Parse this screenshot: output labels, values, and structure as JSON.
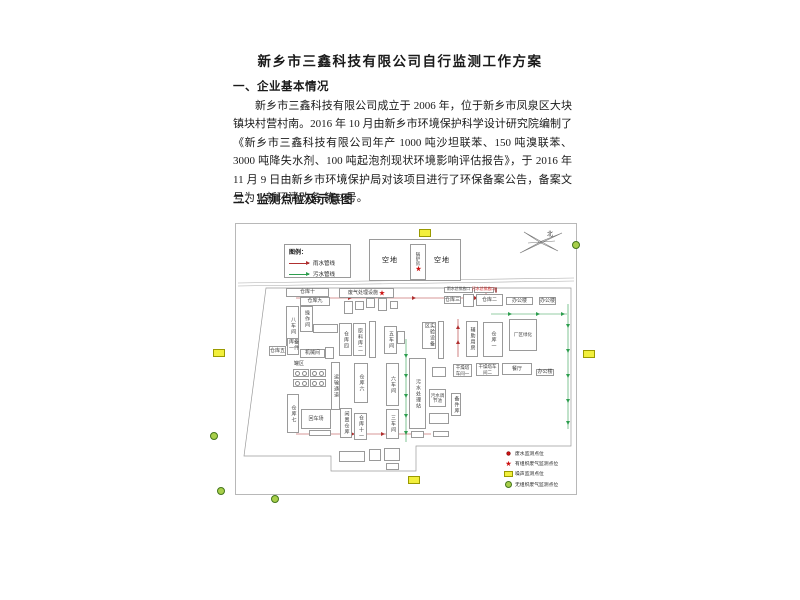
{
  "document": {
    "title": "新乡市三鑫科技有限公司自行监测工作方案",
    "section1_heading": "一、企业基本情况",
    "paragraph": "新乡市三鑫科技有限公司成立于 2006 年，位于新乡市凤泉区大块镇块村营村南。2016 年 10 月由新乡市环境保护科学设计研究院编制了《新乡市三鑫科技有限公司年产 1000 吨沙坦联苯、150 吨溴联苯、3000 吨降失水剂、100 吨起泡剂现状环境影响评估报告》，于 2016 年 11 月 9 日由新乡市环境保护局对该项目进行了环保备案公告，备案文号为：新环清改备 第 2 号。",
    "section2_heading": "二、监测点位及示意图"
  },
  "diagram": {
    "compass_label": "北",
    "pipe_legend": {
      "title": "图例：",
      "items": [
        {
          "name": "rain",
          "label": "雨水管线"
        },
        {
          "name": "sew",
          "label": "污水管线"
        }
      ]
    },
    "site": {
      "left_lot": "空地",
      "right_lot": "空地",
      "boiler": "锅炉房",
      "tank_area": "罐区"
    },
    "buildings": [
      {
        "label": "仓库十",
        "x": 50,
        "y": 64,
        "w": 43,
        "h": 9,
        "mode": "h"
      },
      {
        "label": "仓库九",
        "x": 64,
        "y": 73,
        "w": 30,
        "h": 9,
        "mode": "h"
      },
      {
        "label": "八车间",
        "x": 50,
        "y": 82,
        "w": 13,
        "h": 40,
        "mode": "v"
      },
      {
        "label": "操作间",
        "x": 64,
        "y": 82,
        "w": 13,
        "h": 26,
        "mode": "v"
      },
      {
        "label": "",
        "x": 77,
        "y": 100,
        "w": 25,
        "h": 9,
        "mode": "h"
      },
      {
        "label": "备件库一",
        "x": 51,
        "y": 114,
        "w": 12,
        "h": 17,
        "mode": "v"
      },
      {
        "label": "仓库五",
        "x": 33,
        "y": 122,
        "w": 17,
        "h": 10,
        "mode": "h"
      },
      {
        "label": "机械间",
        "x": 64,
        "y": 125,
        "w": 25,
        "h": 9,
        "mode": "h"
      },
      {
        "label": "",
        "x": 89,
        "y": 123,
        "w": 9,
        "h": 12,
        "mode": "h"
      },
      {
        "label": "",
        "x": 57,
        "y": 145,
        "w": 16,
        "h": 8,
        "mode": "tank"
      },
      {
        "label": "",
        "x": 74,
        "y": 145,
        "w": 16,
        "h": 8,
        "mode": "tank"
      },
      {
        "label": "",
        "x": 57,
        "y": 155,
        "w": 16,
        "h": 8,
        "mode": "tank"
      },
      {
        "label": "",
        "x": 74,
        "y": 155,
        "w": 16,
        "h": 8,
        "mode": "tank"
      },
      {
        "label": "仓库七",
        "x": 51,
        "y": 170,
        "w": 12,
        "h": 39,
        "mode": "v"
      },
      {
        "label": "回车场",
        "x": 65,
        "y": 185,
        "w": 30,
        "h": 20,
        "mode": "h"
      },
      {
        "label": "",
        "x": 73,
        "y": 206,
        "w": 22,
        "h": 6,
        "mode": "h"
      },
      {
        "label": "废气处理设施",
        "x": 103,
        "y": 64,
        "w": 55,
        "h": 10,
        "mode": "h",
        "star": true
      },
      {
        "label": "",
        "x": 108,
        "y": 77,
        "w": 9,
        "h": 13,
        "mode": "h"
      },
      {
        "label": "",
        "x": 119,
        "y": 77,
        "w": 9,
        "h": 9,
        "mode": "h"
      },
      {
        "label": "",
        "x": 130,
        "y": 74,
        "w": 9,
        "h": 10,
        "mode": "h"
      },
      {
        "label": "",
        "x": 142,
        "y": 74,
        "w": 9,
        "h": 13,
        "mode": "h"
      },
      {
        "label": "",
        "x": 154,
        "y": 77,
        "w": 8,
        "h": 8,
        "mode": "h"
      },
      {
        "label": "仓库四",
        "x": 103,
        "y": 99,
        "w": 13,
        "h": 33,
        "mode": "v"
      },
      {
        "label": "原料库二",
        "x": 117,
        "y": 99,
        "w": 13,
        "h": 33,
        "mode": "v"
      },
      {
        "label": "",
        "x": 133,
        "y": 97,
        "w": 7,
        "h": 37,
        "mode": "h"
      },
      {
        "label": "五车间",
        "x": 148,
        "y": 102,
        "w": 13,
        "h": 28,
        "mode": "v"
      },
      {
        "label": "",
        "x": 161,
        "y": 107,
        "w": 8,
        "h": 13,
        "mode": "h"
      },
      {
        "label": "运输通道",
        "x": 95,
        "y": 138,
        "w": 9,
        "h": 48,
        "mode": "v"
      },
      {
        "label": "仓库六",
        "x": 118,
        "y": 139,
        "w": 14,
        "h": 40,
        "mode": "v"
      },
      {
        "label": "六车间",
        "x": 150,
        "y": 139,
        "w": 13,
        "h": 43,
        "mode": "v"
      },
      {
        "label": "三车间",
        "x": 150,
        "y": 185,
        "w": 13,
        "h": 30,
        "mode": "v"
      },
      {
        "label": "闲置仓库",
        "x": 104,
        "y": 184,
        "w": 12,
        "h": 30,
        "mode": "v"
      },
      {
        "label": "仓库十一",
        "x": 118,
        "y": 189,
        "w": 13,
        "h": 27,
        "mode": "v"
      },
      {
        "label": "污水处理站",
        "x": 173,
        "y": 134,
        "w": 17,
        "h": 71,
        "mode": "v"
      },
      {
        "label": "污水调节池",
        "x": 193,
        "y": 165,
        "w": 17,
        "h": 18,
        "mode": "h2"
      },
      {
        "label": "备件库",
        "x": 215,
        "y": 169,
        "w": 10,
        "h": 23,
        "mode": "v"
      },
      {
        "label": "",
        "x": 196,
        "y": 143,
        "w": 14,
        "h": 10,
        "mode": "h"
      },
      {
        "label": "",
        "x": 193,
        "y": 189,
        "w": 20,
        "h": 11,
        "mode": "h"
      },
      {
        "label": "",
        "x": 175,
        "y": 207,
        "w": 13,
        "h": 7,
        "mode": "h"
      },
      {
        "label": "",
        "x": 197,
        "y": 207,
        "w": 16,
        "h": 6,
        "mode": "h"
      },
      {
        "label": "干燥塔车间一",
        "x": 217,
        "y": 140,
        "w": 19,
        "h": 13,
        "mode": "h2"
      },
      {
        "label": "干燥塔车间二",
        "x": 240,
        "y": 139,
        "w": 23,
        "h": 13,
        "mode": "h2"
      },
      {
        "label": "餐厅",
        "x": 266,
        "y": 139,
        "w": 30,
        "h": 12,
        "mode": "h"
      },
      {
        "label": "办公楼",
        "x": 300,
        "y": 145,
        "w": 18,
        "h": 7,
        "mode": "h"
      },
      {
        "label": "仓库三",
        "x": 208,
        "y": 72,
        "w": 17,
        "h": 8,
        "mode": "h"
      },
      {
        "label": "",
        "x": 227,
        "y": 70,
        "w": 11,
        "h": 13,
        "mode": "h"
      },
      {
        "label": "仓库二",
        "x": 240,
        "y": 70,
        "w": 27,
        "h": 12,
        "mode": "h"
      },
      {
        "label": "办公楼",
        "x": 270,
        "y": 73,
        "w": 27,
        "h": 8,
        "mode": "h"
      },
      {
        "label": "办公楼",
        "x": 303,
        "y": 73,
        "w": 17,
        "h": 8,
        "mode": "h"
      },
      {
        "label": "实验设备区",
        "x": 186,
        "y": 98,
        "w": 14,
        "h": 27,
        "mode": "v"
      },
      {
        "label": "",
        "x": 202,
        "y": 97,
        "w": 6,
        "h": 38,
        "mode": "h"
      },
      {
        "label": "辅助用房",
        "x": 230,
        "y": 97,
        "w": 12,
        "h": 36,
        "mode": "v"
      },
      {
        "label": "仓库一",
        "x": 247,
        "y": 98,
        "w": 20,
        "h": 35,
        "mode": "v"
      },
      {
        "label": "厂区绿化",
        "x": 273,
        "y": 95,
        "w": 28,
        "h": 32,
        "mode": "h2"
      },
      {
        "label": "雨水总排放口",
        "x": 208,
        "y": 63,
        "w": 29,
        "h": 6,
        "mode": "lbl"
      },
      {
        "label": "污水总排放口",
        "x": 238,
        "y": 63,
        "w": 20,
        "h": 6,
        "mode": "lbl",
        "red": true,
        "dot": true
      },
      {
        "label": "",
        "x": 103,
        "y": 227,
        "w": 26,
        "h": 11,
        "mode": "h"
      },
      {
        "label": "",
        "x": 133,
        "y": 225,
        "w": 12,
        "h": 12,
        "mode": "h"
      },
      {
        "label": "",
        "x": 148,
        "y": 224,
        "w": 16,
        "h": 13,
        "mode": "h"
      },
      {
        "label": "",
        "x": 150,
        "y": 239,
        "w": 13,
        "h": 7,
        "mode": "h"
      }
    ],
    "point_legend": [
      {
        "symbol": "dot",
        "label": "废水监测点位"
      },
      {
        "symbol": "star",
        "label": "有组织废气监测点位"
      },
      {
        "symbol": "noise",
        "label": "噪声监测点位"
      },
      {
        "symbol": "gas",
        "label": "无组织废气监测点位"
      }
    ],
    "colors": {
      "rain": "#b03030",
      "sewage": "#2e9e4f",
      "noise_fill": "#f2ef3c",
      "noise_border": "#9a9a00",
      "gas_fill": "#a8cf4a",
      "gas_border": "#44761c",
      "monitor_red": "#cc1111"
    },
    "markers": {
      "noise": [
        {
          "x": 419,
          "y": 229
        },
        {
          "x": 213,
          "y": 349
        },
        {
          "x": 583,
          "y": 350
        },
        {
          "x": 408,
          "y": 476
        }
      ],
      "gas": [
        {
          "x": 575,
          "y": 244
        },
        {
          "x": 213,
          "y": 435
        },
        {
          "x": 220,
          "y": 490
        },
        {
          "x": 274,
          "y": 498
        }
      ]
    }
  }
}
